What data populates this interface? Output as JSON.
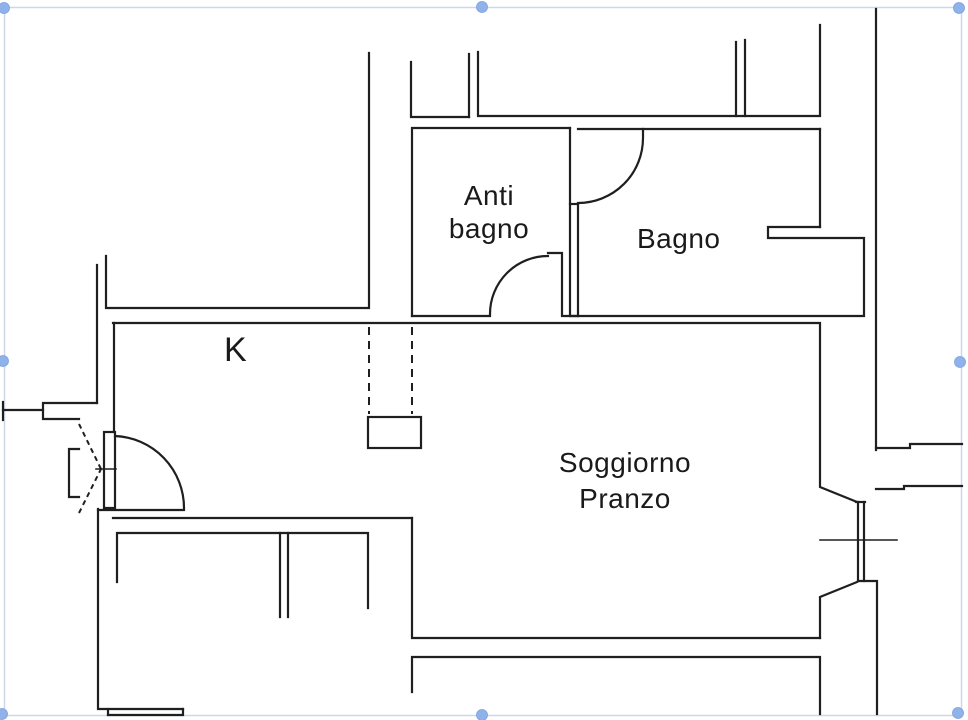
{
  "selection": {
    "border_color": "#ccd7ea",
    "handle_color": "#8fb2ea",
    "handle_positions": [
      "top-left",
      "top-center",
      "top-right",
      "middle-left",
      "middle-right",
      "bottom-left",
      "bottom-center",
      "bottom-right"
    ]
  },
  "plan": {
    "colors": {
      "line": "#1f1f1f",
      "background": "#ffffff"
    },
    "labels": {
      "antibagno": {
        "line1": "Anti",
        "line2": "bagno"
      },
      "bagno": {
        "text": "Bagno"
      },
      "kitchen": {
        "text": "K"
      },
      "soggiorno": {
        "line1": "Soggiorno",
        "line2": "Pranzo"
      }
    }
  }
}
